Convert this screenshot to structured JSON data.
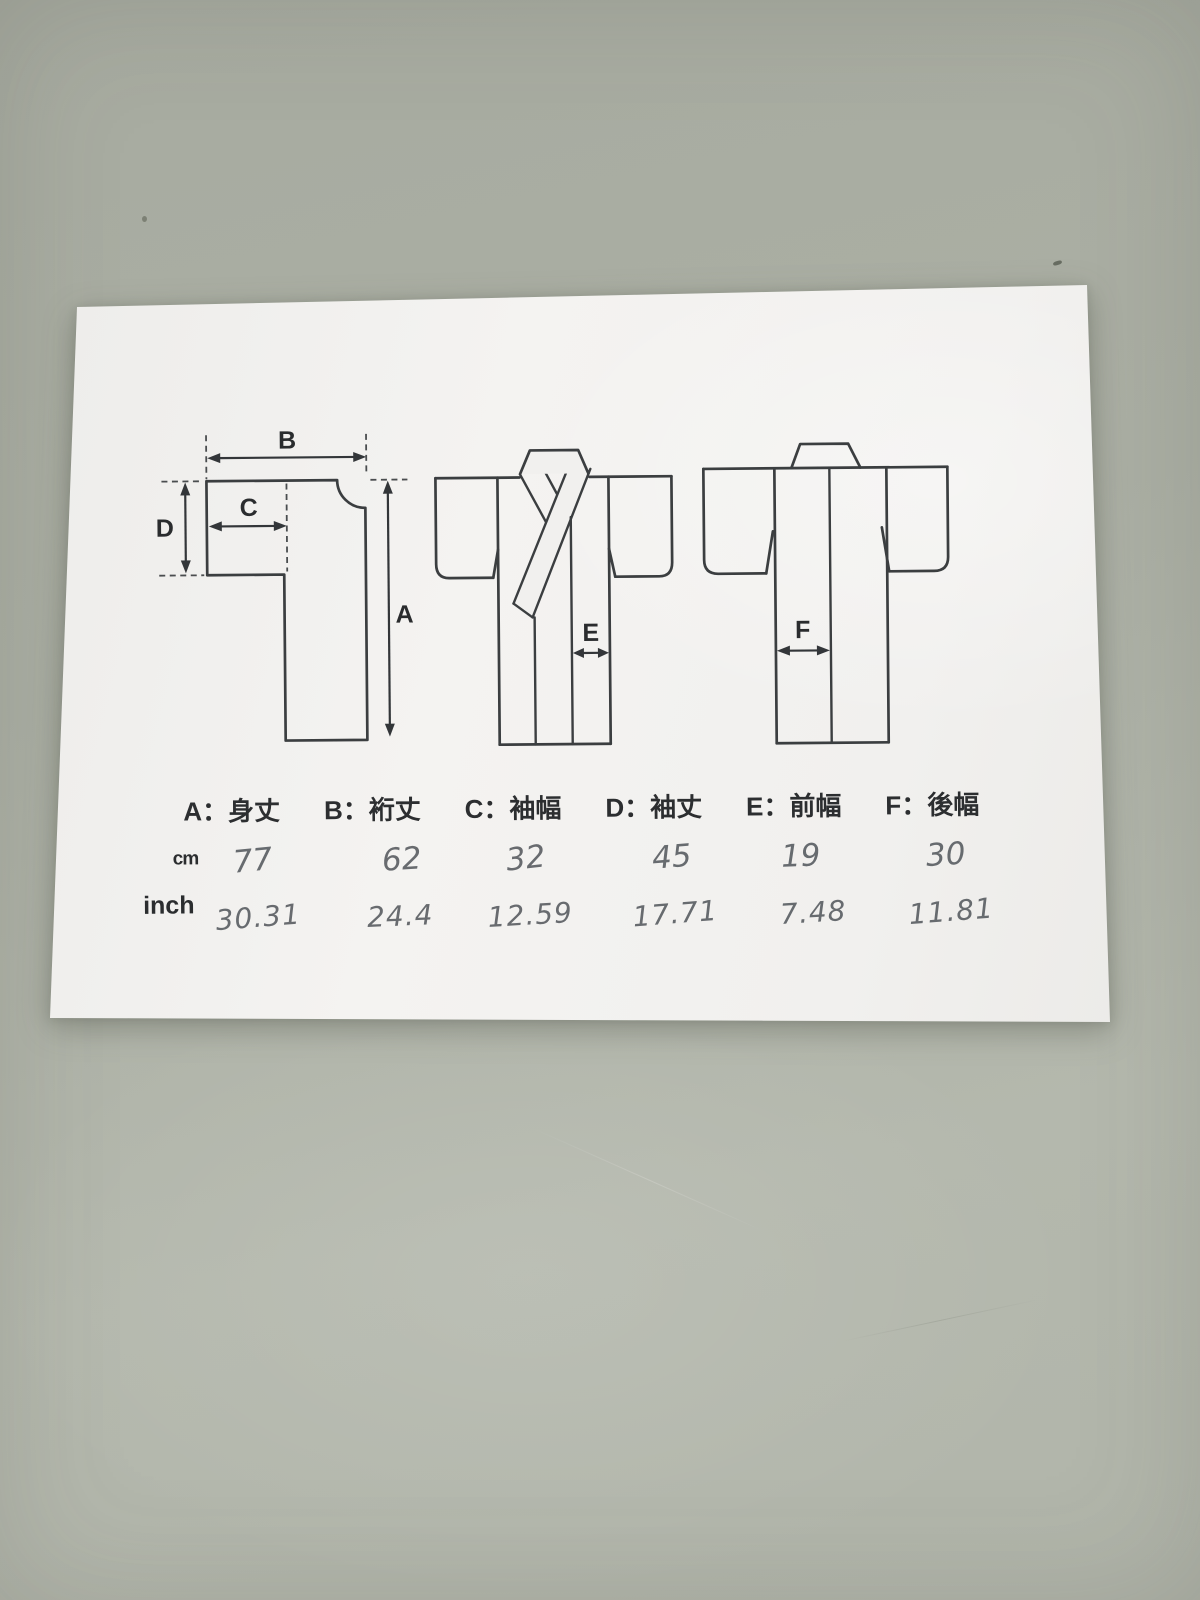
{
  "scene": {
    "background_color": "#abafa4",
    "paper_color": "#f1f0ee",
    "line_color": "#3b3e40"
  },
  "diagram": {
    "arrow_labels": {
      "a": "A",
      "b": "B",
      "c": "C",
      "d": "D",
      "e": "E",
      "f": "F"
    }
  },
  "legend": {
    "items": [
      {
        "text": "A：身丈"
      },
      {
        "text": "B：裄丈"
      },
      {
        "text": "C：袖幅"
      },
      {
        "text": "D：袖丈"
      },
      {
        "text": "E：前幅"
      },
      {
        "text": "F：後幅"
      }
    ]
  },
  "table": {
    "cm": {
      "label": "cm",
      "values": [
        "77",
        "62",
        "32",
        "45",
        "19",
        "30"
      ]
    },
    "inch": {
      "label": "inch",
      "values": [
        "30.31",
        "24.4",
        "12.59",
        "17.71",
        "7.48",
        "11.81"
      ]
    }
  }
}
